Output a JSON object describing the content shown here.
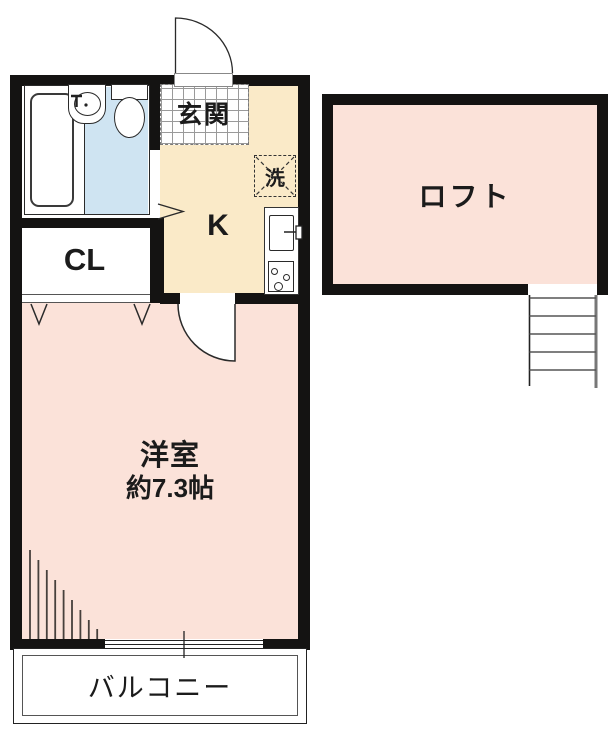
{
  "plan": {
    "entrance": {
      "label": "玄関"
    },
    "kitchen": {
      "label": "K"
    },
    "washer": {
      "label": "洗"
    },
    "closet": {
      "label": "CL"
    },
    "room": {
      "label": "洋室",
      "size": "約7.3帖"
    },
    "balcony": {
      "label": "バルコニー"
    },
    "loft": {
      "label": "ロフト"
    }
  },
  "colors": {
    "wall": "#141312",
    "room_pink": "#fbe2d9",
    "kitchen_beige": "#faeac8",
    "bath_blue": "#cfe4f2",
    "tile_line": "#9a9a9a"
  }
}
